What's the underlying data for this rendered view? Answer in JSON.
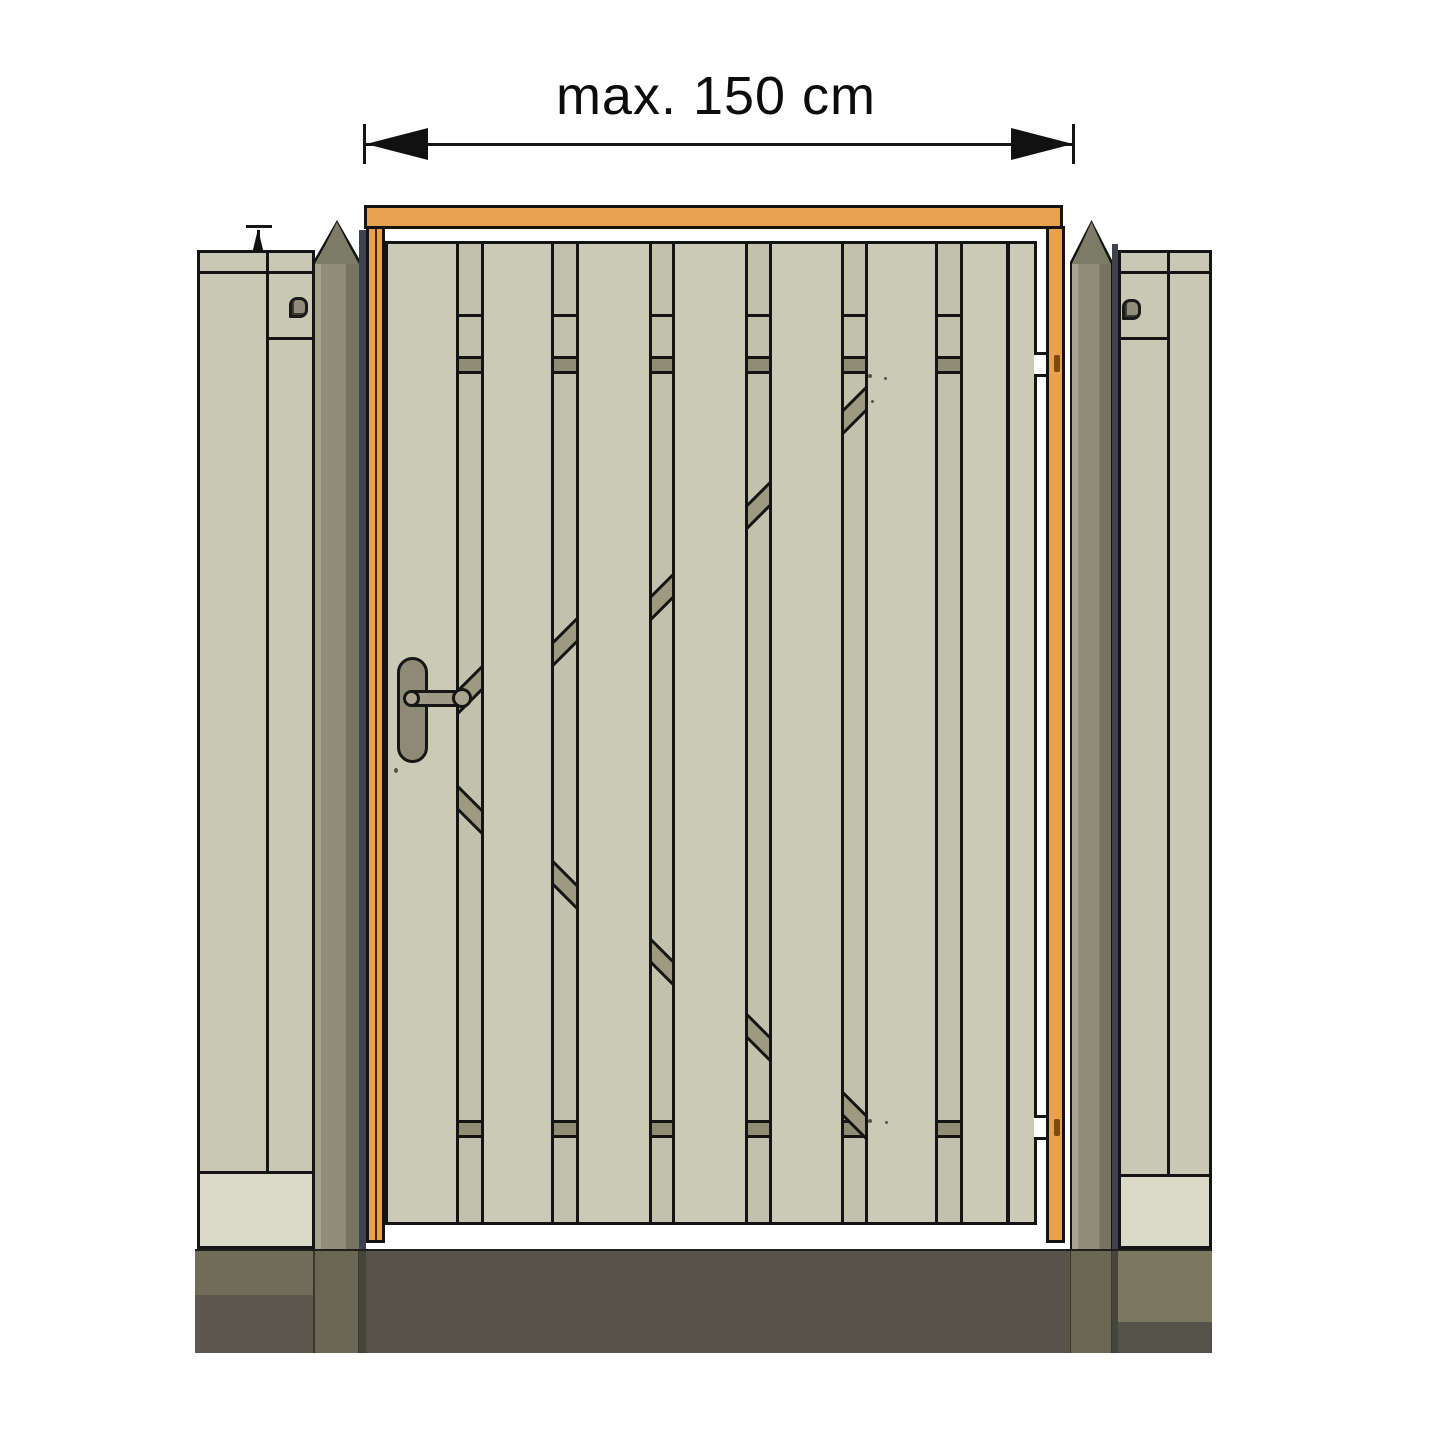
{
  "labels": {
    "width_dimension": "max. 150 cm",
    "height_dimension": "max. 210 cm"
  },
  "colors": {
    "outline": "#141414",
    "orange": "#E8A14E",
    "orange_dark": "#7A4A17",
    "plank": "#CBCAB6",
    "back_plank": "#C2C1AD",
    "band": "#8F8E74",
    "brace": "#9C9A80",
    "fence": "#C9C8B5",
    "fence_light": "#DADAC8",
    "post": "#908E79",
    "post_light": "#A6A48E",
    "post_shade": "#76745F",
    "post_cap": "#7C7B66",
    "steel": "#3E4150",
    "handle": "#8D8B76",
    "handle_bar": "#9D9B85",
    "ground_center": "#575349",
    "ground_left": "#6F6C58",
    "ground_left_dark": "#5B574C",
    "ground_right": "#7B785F",
    "ground_right_dark": "#55524A",
    "ground_post": "#6A6753",
    "ground_steel": "#44453C"
  },
  "gate": {
    "leaf_top": 241,
    "features": {
      "break_y": 314,
      "upper_band_y": 356,
      "lower_band_y": 1120
    },
    "columns": [
      {
        "kind": "plank",
        "w": 68
      },
      {
        "kind": "gap",
        "w": 28,
        "braces": [
          {
            "y": 690,
            "slash": true
          },
          {
            "y": 810,
            "slash": false
          }
        ]
      },
      {
        "kind": "plank",
        "w": 67
      },
      {
        "kind": "gap",
        "w": 28,
        "braces": [
          {
            "y": 642,
            "slash": true
          },
          {
            "y": 885,
            "slash": false
          }
        ]
      },
      {
        "kind": "plank",
        "w": 70
      },
      {
        "kind": "gap",
        "w": 26,
        "braces": [
          {
            "y": 597,
            "slash": true
          },
          {
            "y": 962,
            "slash": false
          }
        ]
      },
      {
        "kind": "plank",
        "w": 70
      },
      {
        "kind": "gap",
        "w": 27,
        "braces": [
          {
            "y": 505,
            "slash": true
          },
          {
            "y": 1038,
            "slash": false
          }
        ]
      },
      {
        "kind": "plank",
        "w": 69
      },
      {
        "kind": "gap",
        "w": 27,
        "braces": [
          {
            "y": 410,
            "slash": true
          },
          {
            "y": 1116,
            "slash": false
          }
        ]
      },
      {
        "kind": "plank",
        "w": 67
      },
      {
        "kind": "gap",
        "w": 28,
        "braces": []
      },
      {
        "kind": "plank",
        "w": 43
      },
      {
        "kind": "divider",
        "w": 4
      },
      {
        "kind": "plank",
        "w": 24
      }
    ]
  }
}
